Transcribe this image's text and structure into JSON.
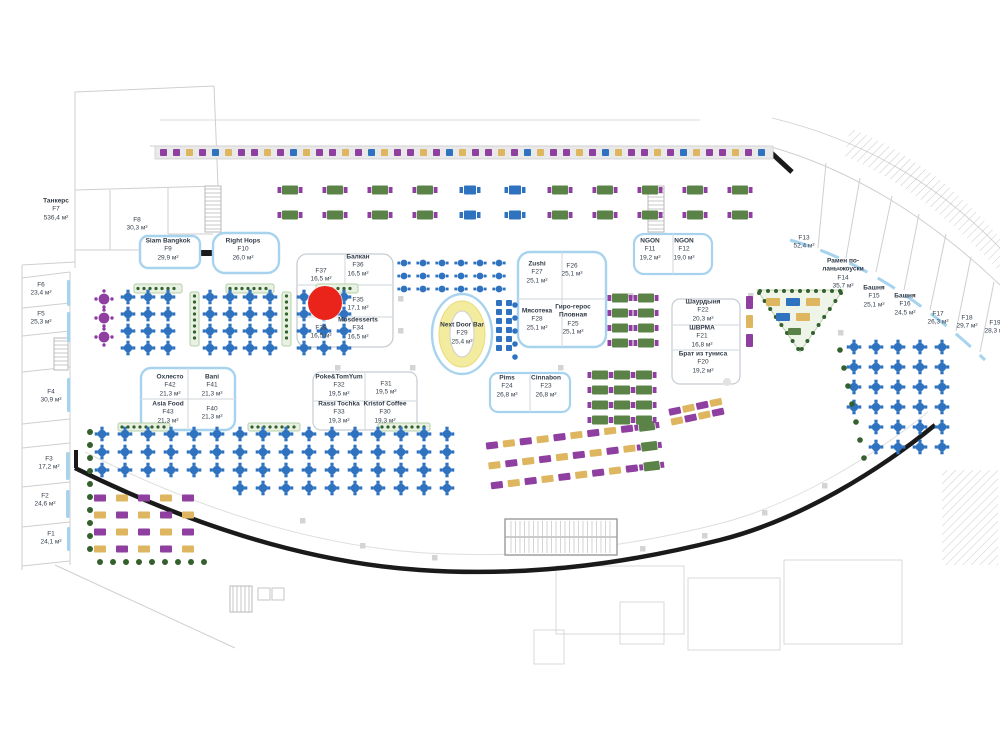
{
  "floorplan": {
    "type": "mall-food-court-plan",
    "area_unit": "м²",
    "marker": {
      "x": 325,
      "y": 303,
      "r": 17,
      "color": "#ea241a"
    },
    "palette": {
      "seat_blue": "#2f72bf",
      "seat_purple": "#8e3fa0",
      "seat_yellow": "#ddb65f",
      "seat_green": "#5b8348",
      "planter_green": "#33602c",
      "counter_blue": "#a7d3ee",
      "wall_black": "#1a1a1a",
      "outline_gray": "#cfcfcf"
    },
    "stalls": [
      {
        "code": "F7",
        "name": "Танкерс",
        "area": "536,4 м²",
        "cx": 56,
        "cy": 210
      },
      {
        "code": "F8",
        "name": "",
        "area": "30,3 м²",
        "cx": 137,
        "cy": 225
      },
      {
        "code": "F9",
        "name": "Siam Bangkok",
        "area": "29,9 м²",
        "cx": 168,
        "cy": 250
      },
      {
        "code": "F10",
        "name": "Right Hops",
        "area": "26,0 м²",
        "cx": 243,
        "cy": 250
      },
      {
        "code": "F6",
        "name": "",
        "area": "23,4 м²",
        "cx": 41,
        "cy": 290
      },
      {
        "code": "F5",
        "name": "",
        "area": "25,3 м²",
        "cx": 41,
        "cy": 319
      },
      {
        "code": "F4",
        "name": "",
        "area": "30,9 м²",
        "cx": 51,
        "cy": 397
      },
      {
        "code": "F3",
        "name": "",
        "area": "17,2 м²",
        "cx": 49,
        "cy": 464
      },
      {
        "code": "F2",
        "name": "",
        "area": "24,6 м²",
        "cx": 45,
        "cy": 501
      },
      {
        "code": "F1",
        "name": "",
        "area": "24,1 м²",
        "cx": 51,
        "cy": 539
      },
      {
        "code": "F37",
        "name": "",
        "area": "16,5 м²",
        "cx": 321,
        "cy": 276
      },
      {
        "code": "F36",
        "name": "Балкан",
        "area": "16,5 м²",
        "cx": 358,
        "cy": 266
      },
      {
        "code": "F35",
        "name": "",
        "area": "17,1 м²",
        "cx": 358,
        "cy": 305
      },
      {
        "code": "F39",
        "name": "",
        "area": "16,5 м²",
        "cx": 321,
        "cy": 333
      },
      {
        "code": "F34",
        "name": "Mosdesserts",
        "area": "16,5 м²",
        "cx": 358,
        "cy": 329
      },
      {
        "code": "F29",
        "name": "Next Door Bar",
        "area": "25,4 м²",
        "cx": 462,
        "cy": 334
      },
      {
        "code": "F27",
        "name": "Zushi",
        "area": "25,1 м²",
        "cx": 537,
        "cy": 273
      },
      {
        "code": "F26",
        "name": "",
        "area": "25,1 м²",
        "cx": 572,
        "cy": 271
      },
      {
        "code": "F28",
        "name": "Мясотека",
        "area": "25,1 м²",
        "cx": 537,
        "cy": 320
      },
      {
        "code": "F25",
        "name": "Гиро-герос",
        "name2": "Пловная",
        "area": "25,1 м²",
        "cx": 573,
        "cy": 320
      },
      {
        "code": "F11",
        "name": "NGON",
        "area": "19,2 м²",
        "cx": 650,
        "cy": 250
      },
      {
        "code": "F12",
        "name": "NGON",
        "area": "19,0 м²",
        "cx": 684,
        "cy": 250
      },
      {
        "code": "F22",
        "name": "Шаурдыня",
        "area": "20,3 м²",
        "cx": 703,
        "cy": 311
      },
      {
        "code": "F21",
        "name": "ШВРМА",
        "area": "16,8 м²",
        "cx": 702,
        "cy": 337
      },
      {
        "code": "F20",
        "name": "Брат из туниса",
        "area": "19,2 м²",
        "cx": 703,
        "cy": 363
      },
      {
        "code": "F13",
        "name": "",
        "area": "52,4 м²",
        "cx": 804,
        "cy": 243
      },
      {
        "code": "F14",
        "name": "Рамен по-",
        "name2": "ланьчжоуски",
        "area": "35,7 м²",
        "cx": 843,
        "cy": 274
      },
      {
        "code": "F15",
        "name": "Башня",
        "area": "25,1 м²",
        "cx": 874,
        "cy": 297
      },
      {
        "code": "F16",
        "name": "Башня",
        "area": "24,5 м²",
        "cx": 905,
        "cy": 305
      },
      {
        "code": "F17",
        "name": "",
        "area": "26,3 м²",
        "cx": 938,
        "cy": 319
      },
      {
        "code": "F18",
        "name": "",
        "area": "29,7 м²",
        "cx": 967,
        "cy": 323
      },
      {
        "code": "F19",
        "name": "",
        "area": "28,3 м²",
        "cx": 995,
        "cy": 328
      },
      {
        "code": "F42",
        "name": "Охлесто",
        "area": "21,3 м²",
        "cx": 170,
        "cy": 386
      },
      {
        "code": "F41",
        "name": "Bani",
        "area": "21,3 м²",
        "cx": 212,
        "cy": 386
      },
      {
        "code": "F43",
        "name": "Asia Food",
        "area": "21,3 м²",
        "cx": 168,
        "cy": 413
      },
      {
        "code": "F40",
        "name": "",
        "area": "21,3 м²",
        "cx": 212,
        "cy": 414
      },
      {
        "code": "F32",
        "name": "Poke&TomYum",
        "area": "19,5 м²",
        "cx": 339,
        "cy": 386
      },
      {
        "code": "F31",
        "name": "",
        "area": "19,5 м²",
        "cx": 386,
        "cy": 389
      },
      {
        "code": "F33",
        "name": "Rassi Tochka",
        "area": "19,3 м²",
        "cx": 339,
        "cy": 413
      },
      {
        "code": "F30",
        "name": "Kristof Coffee",
        "area": "19,3 м²",
        "cx": 385,
        "cy": 413
      },
      {
        "code": "F24",
        "name": "Pims",
        "area": "26,8 м²",
        "cx": 507,
        "cy": 387
      },
      {
        "code": "F23",
        "name": "Cinnabon",
        "area": "26,8 м²",
        "cx": 546,
        "cy": 387
      }
    ]
  }
}
